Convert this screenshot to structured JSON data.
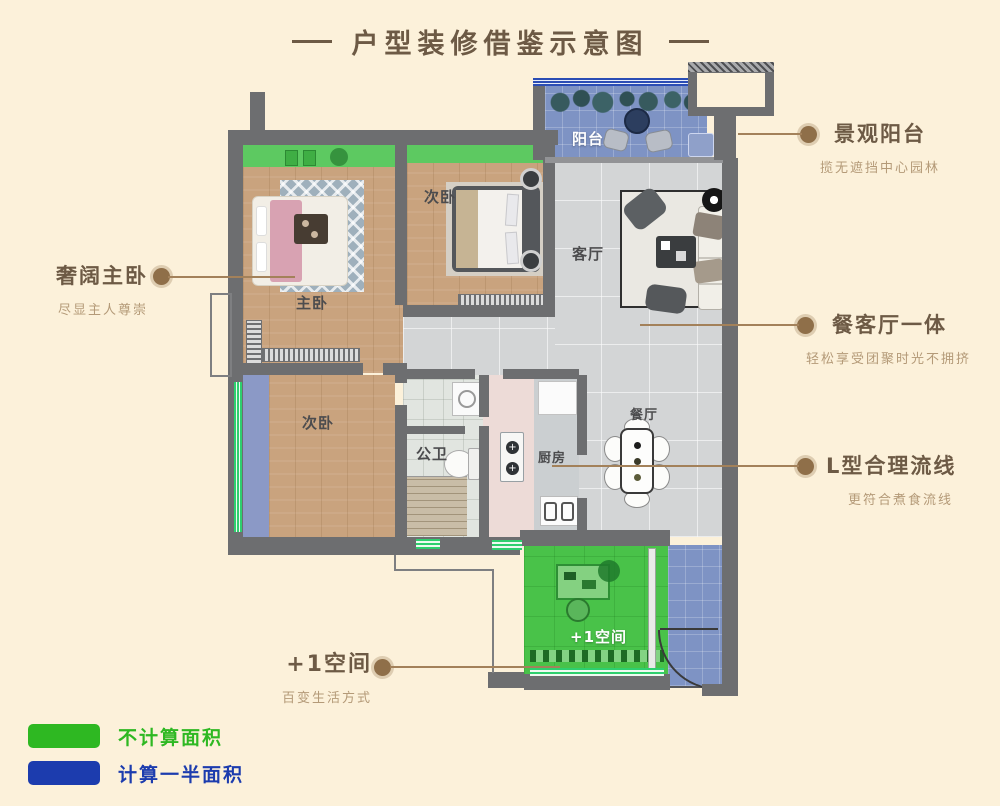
{
  "header": {
    "title": "户型装修借鉴示意图"
  },
  "plan": {
    "rooms": {
      "balcony": "阳台",
      "bedroom_top": "次卧",
      "living": "客厅",
      "master": "主卧",
      "bedroom_bottom": "次卧",
      "bathroom": "公卫",
      "kitchen": "厨房",
      "dining": "餐厅",
      "plus_space": "+1空间"
    }
  },
  "callouts": {
    "master": {
      "title": "奢阔主卧",
      "subtitle": "尽显主人尊崇"
    },
    "balcony": {
      "title": "景观阳台",
      "subtitle": "揽无遮挡中心园林"
    },
    "living_dining": {
      "title": "餐客厅一体",
      "subtitle": "轻松享受团聚时光不拥挤"
    },
    "kitchen_flow": {
      "title": "L型合理流线",
      "subtitle": "更符合煮食流线"
    },
    "plus_space": {
      "title": "+1空间",
      "subtitle": "百变生活方式"
    }
  },
  "legend": {
    "items": [
      {
        "label": "不计算面积",
        "color": "#2eb822"
      },
      {
        "label": "计算一半面积",
        "color": "#1c3cae"
      }
    ]
  },
  "colors": {
    "background": "#fcf1da",
    "title_brown": "#6d5a45",
    "subtitle_brown": "#b49a78",
    "callout_line": "#a3815a",
    "wall_gray": "#6d6e70",
    "wood_floor": "#c9a37e",
    "tile_floor": "#d3d5d6",
    "bay_window_green": "#5dc961",
    "overlay_green": "#49c249",
    "overlay_blue": "#7e93c4",
    "legend_green": "#2eb822",
    "legend_blue": "#1c3cae"
  }
}
